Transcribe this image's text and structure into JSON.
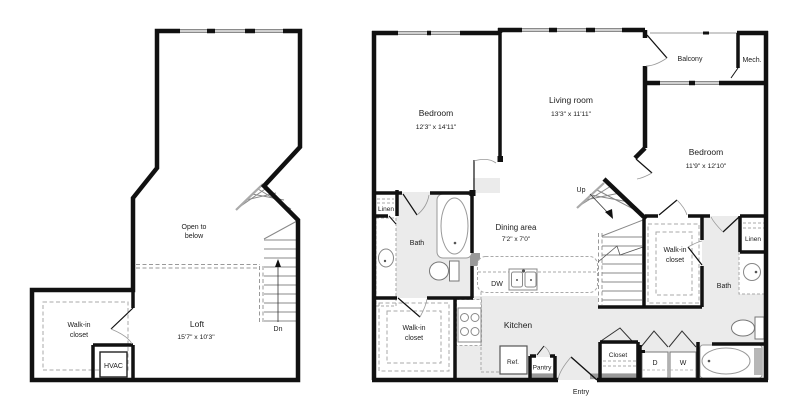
{
  "title": "Two-level apartment floor plan",
  "colors": {
    "wall": "#111111",
    "floor_gray": "#ebebeb",
    "threshold_gray": "#999999",
    "fixture_stroke": "#888888",
    "dash_stroke": "#aaaaaa"
  },
  "left_plan": {
    "open_to_below": {
      "line1": "Open to",
      "line2": "below"
    },
    "loft": {
      "name": "Loft",
      "dims": "15'7\" x 10'3\""
    },
    "walk_in_closet": {
      "line1": "Walk-in",
      "line2": "closet"
    },
    "hvac_label": "HVAC",
    "down_label": "Dn"
  },
  "right_plan": {
    "bedroom_left": {
      "name": "Bedroom",
      "dims": "12'3\" x 14'11\""
    },
    "living_room": {
      "name": "Living room",
      "dims": "13'3\" x 11'11\""
    },
    "bedroom_right": {
      "name": "Bedroom",
      "dims": "11'9\" x 12'10\""
    },
    "balcony_label": "Balcony",
    "mech_label": "Mech.",
    "dining_area": {
      "name": "Dining area",
      "dims": "7'2\" x 7'0\""
    },
    "kitchen_label": "Kitchen",
    "dishwasher_label": "DW",
    "refrigerator_label": "Ref.",
    "pantry_label": "Pantry",
    "entry_label": "Entry",
    "closet_label": "Closet",
    "dryer_label": "D",
    "washer_label": "W",
    "linen_left_label": "Linen",
    "linen_right_label": "Linen",
    "bath_left_label": "Bath",
    "bath_right_label": "Bath",
    "walk_in_closet_left": {
      "line1": "Walk-in",
      "line2": "closet"
    },
    "walk_in_closet_right": {
      "line1": "Walk-in",
      "line2": "closet"
    },
    "up_label": "Up"
  }
}
